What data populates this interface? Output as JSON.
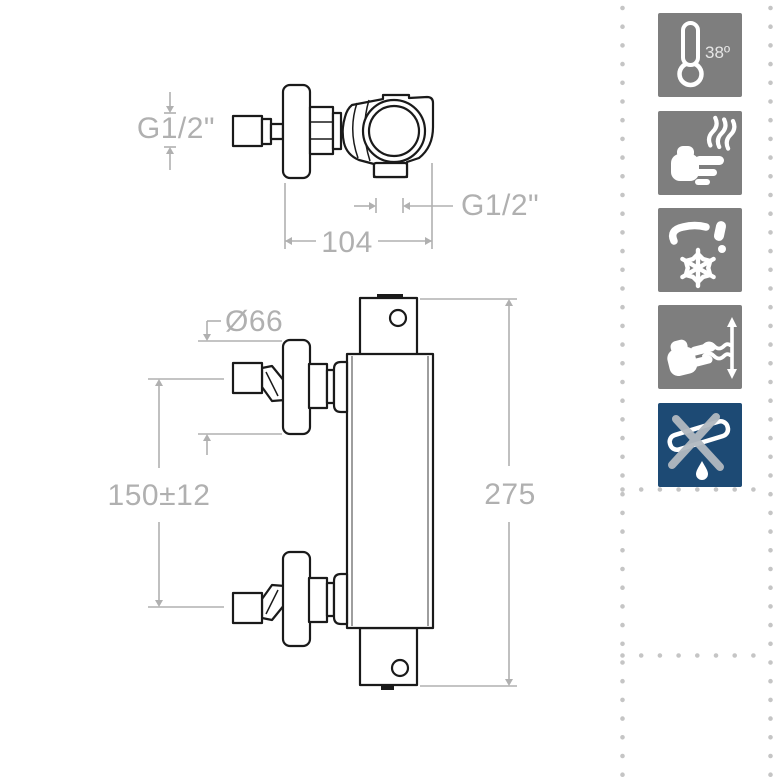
{
  "css_vars": {
    "line": "#1a1a1a",
    "dim": "#b0b0b0",
    "tile": "#7e7e7e",
    "tile-blue": "#1d4a74",
    "glyph": "#ffffff",
    "cross": "#b2b9c0",
    "dots": "#c5c5c5"
  },
  "drawing": {
    "labels": {
      "inlet_thread": "G1/2\"",
      "overall_width": "104",
      "outlet_thread": "G1/2\"",
      "flange_diameter": "Ø66",
      "inlet_distance": "150±12",
      "overall_height": "275"
    }
  },
  "feature_icons": {
    "items": [
      {
        "name": "thermometer-38-icon",
        "label": "38º"
      },
      {
        "name": "anti-scald-hand-heat-icon",
        "label": ""
      },
      {
        "name": "frost-protection-tap-snowflake-icon",
        "label": ""
      },
      {
        "name": "flow-adjust-hand-arrows-icon",
        "label": ""
      },
      {
        "name": "no-bath-spout-crossed-icon",
        "label": ""
      }
    ]
  }
}
